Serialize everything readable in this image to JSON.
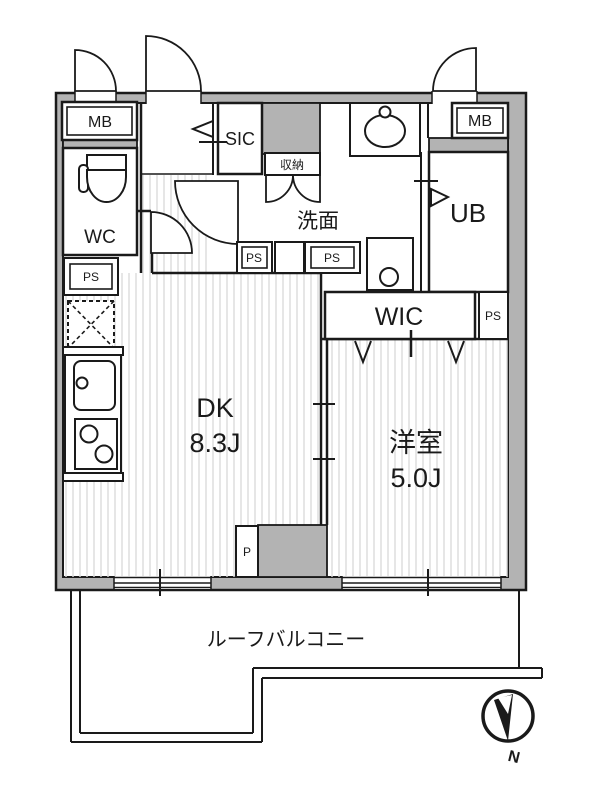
{
  "title": "apartment-floor-plan",
  "colors": {
    "wall_fill": "#b3b3b3",
    "line": "#1a1a1a",
    "floor_stripe": "#dcdcdc"
  },
  "labels": {
    "meter_box": "MB",
    "toilet_room": "WC",
    "pipe_space": "PS",
    "shoe_closet": "SIC",
    "storage": "収納",
    "washroom": "洗面",
    "unit_bath": "UB",
    "walk_in_closet": "WIC",
    "pillar": "P",
    "balcony": "ルーフバルコニー",
    "north": "N"
  },
  "rooms": {
    "dining_kitchen": {
      "name": "DK",
      "size": "8.3J"
    },
    "western_room": {
      "name": "洋室",
      "size": "5.0J"
    }
  }
}
